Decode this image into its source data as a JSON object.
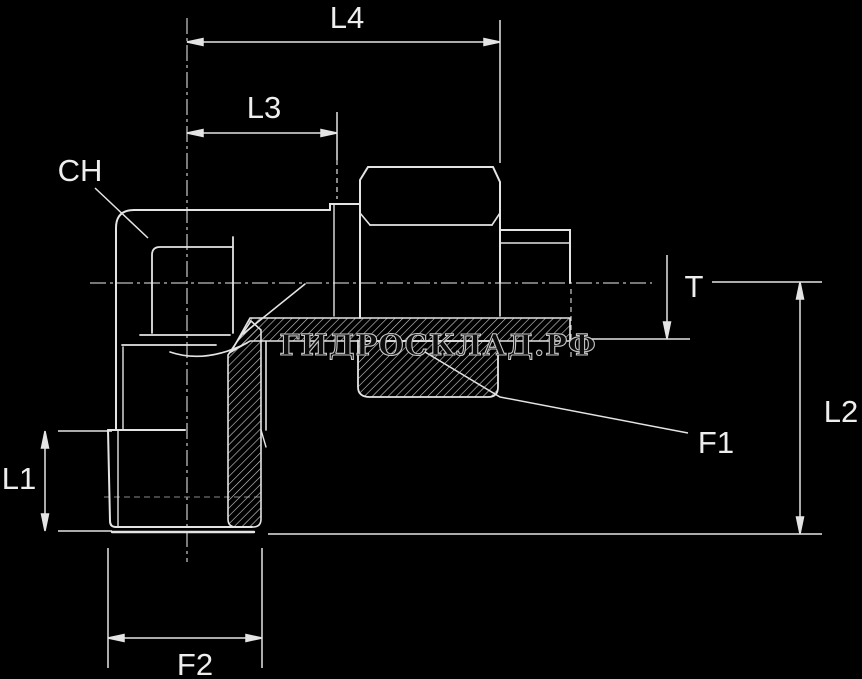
{
  "drawing": {
    "type": "technical-drawing",
    "part": "elbow-compression-fitting-section-view",
    "watermark": "ГИДРОСКЛАД.РФ",
    "labels": {
      "l4": "L4",
      "l3": "L3",
      "ch": "CH",
      "t": "T",
      "l2": "L2",
      "l1": "L1",
      "f1": "F1",
      "f2": "F2"
    },
    "colors": {
      "background": "#000000",
      "line": "#e4e4e4",
      "thin_line": "#9a9a9a",
      "label_text": "#eeeeee",
      "hatch": "#d2d2d2",
      "watermark_fill": "#0c0c0c",
      "watermark_outline": "#c8c8c8"
    }
  }
}
